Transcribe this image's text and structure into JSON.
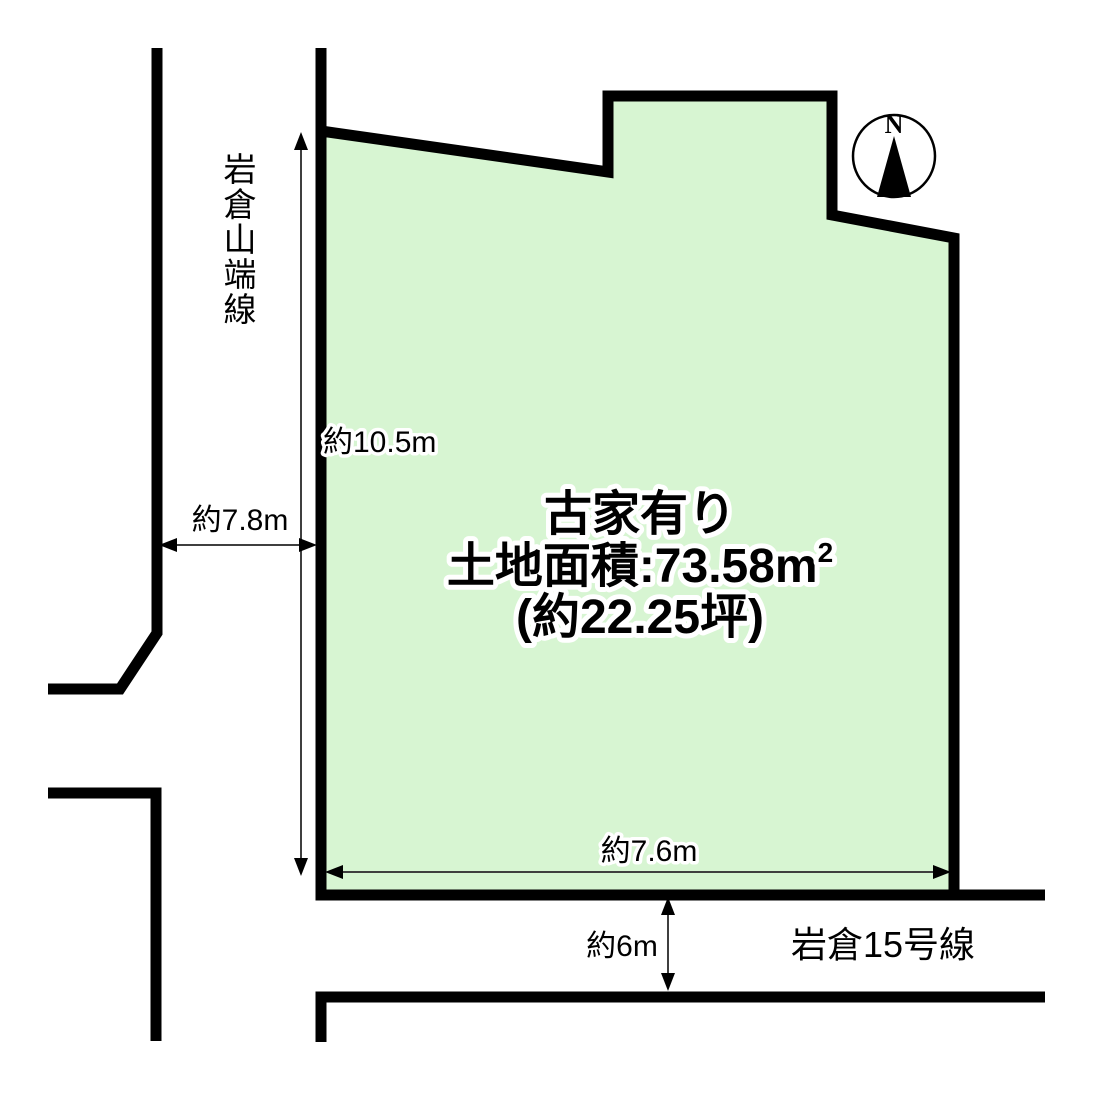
{
  "diagram": {
    "background_color": "#ffffff",
    "line_color": "#000000",
    "plot": {
      "fill_color": "#d7f5d2",
      "label_lines": {
        "line1": "古家有り",
        "line2_prefix": "土地面積:73.58",
        "line2_unit_base": "m",
        "line2_unit_sup": "2",
        "line3": "(約22.25坪)"
      }
    },
    "dimensions": {
      "west_frontage": "約10.5m",
      "west_road_width": "約7.8m",
      "south_frontage": "約7.6m",
      "south_road_width": "約6m"
    },
    "roads": {
      "west_name": "岩倉山端線",
      "south_name": "岩倉15号線"
    },
    "compass": {
      "label": "N"
    }
  }
}
